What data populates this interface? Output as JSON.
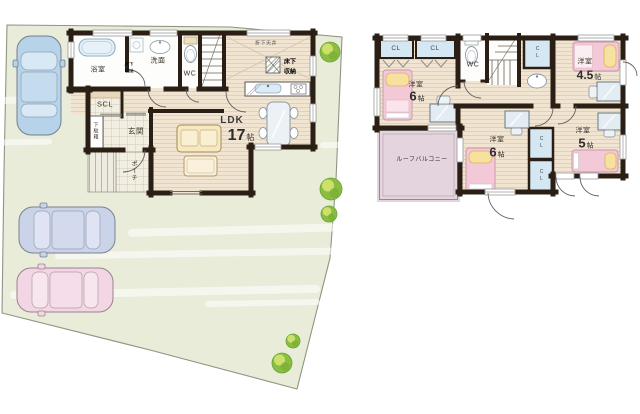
{
  "floor1": {
    "bath": "浴室",
    "bath_storage_line1": "床下",
    "bath_storage_line2": "収納",
    "washroom": "洗面",
    "wc": "WC",
    "dropped_ceiling": "折下天井",
    "underfloor_line1": "床下",
    "underfloor_line2": "収納",
    "scl": "SCL",
    "shoe_cabinet": "下駄箱",
    "entrance": "玄関",
    "porch": "ポーチ",
    "ldk_label": "LDK",
    "ldk_size": "17",
    "ldk_unit": "帖"
  },
  "floor2": {
    "closet_a": "CL",
    "closet_b": "CL",
    "wc": "WC",
    "closet_side": "CL",
    "closet_mid1": "CL",
    "closet_mid2": "CL",
    "room_nw_label": "洋室",
    "room_nw_size": "6",
    "room_nw_unit": "帖",
    "room_ne_label": "洋室",
    "room_ne_size": "4.5",
    "room_ne_unit": "帖",
    "room_s_label": "洋室",
    "room_s_size": "6",
    "room_s_unit": "帖",
    "room_se_label": "洋室",
    "room_se_size": "5",
    "room_se_unit": "帖",
    "roof_balcony": "ルーフバルコニー"
  },
  "colors": {
    "site_green": "#e9ecd8",
    "wall_dark": "#2b1f15",
    "wood_floor": "#f1e4d0",
    "closet_blue": "#d4e7f3",
    "balcony_mauve": "#e3d4dd",
    "bed_pink": "#f4c9d7",
    "pillow_yellow": "#f6e29e",
    "tree_green": "#8abd41",
    "car_blue": "#b7d3e9",
    "car_lavender": "#cbd3e9",
    "car_pink": "#f2d6e3"
  }
}
